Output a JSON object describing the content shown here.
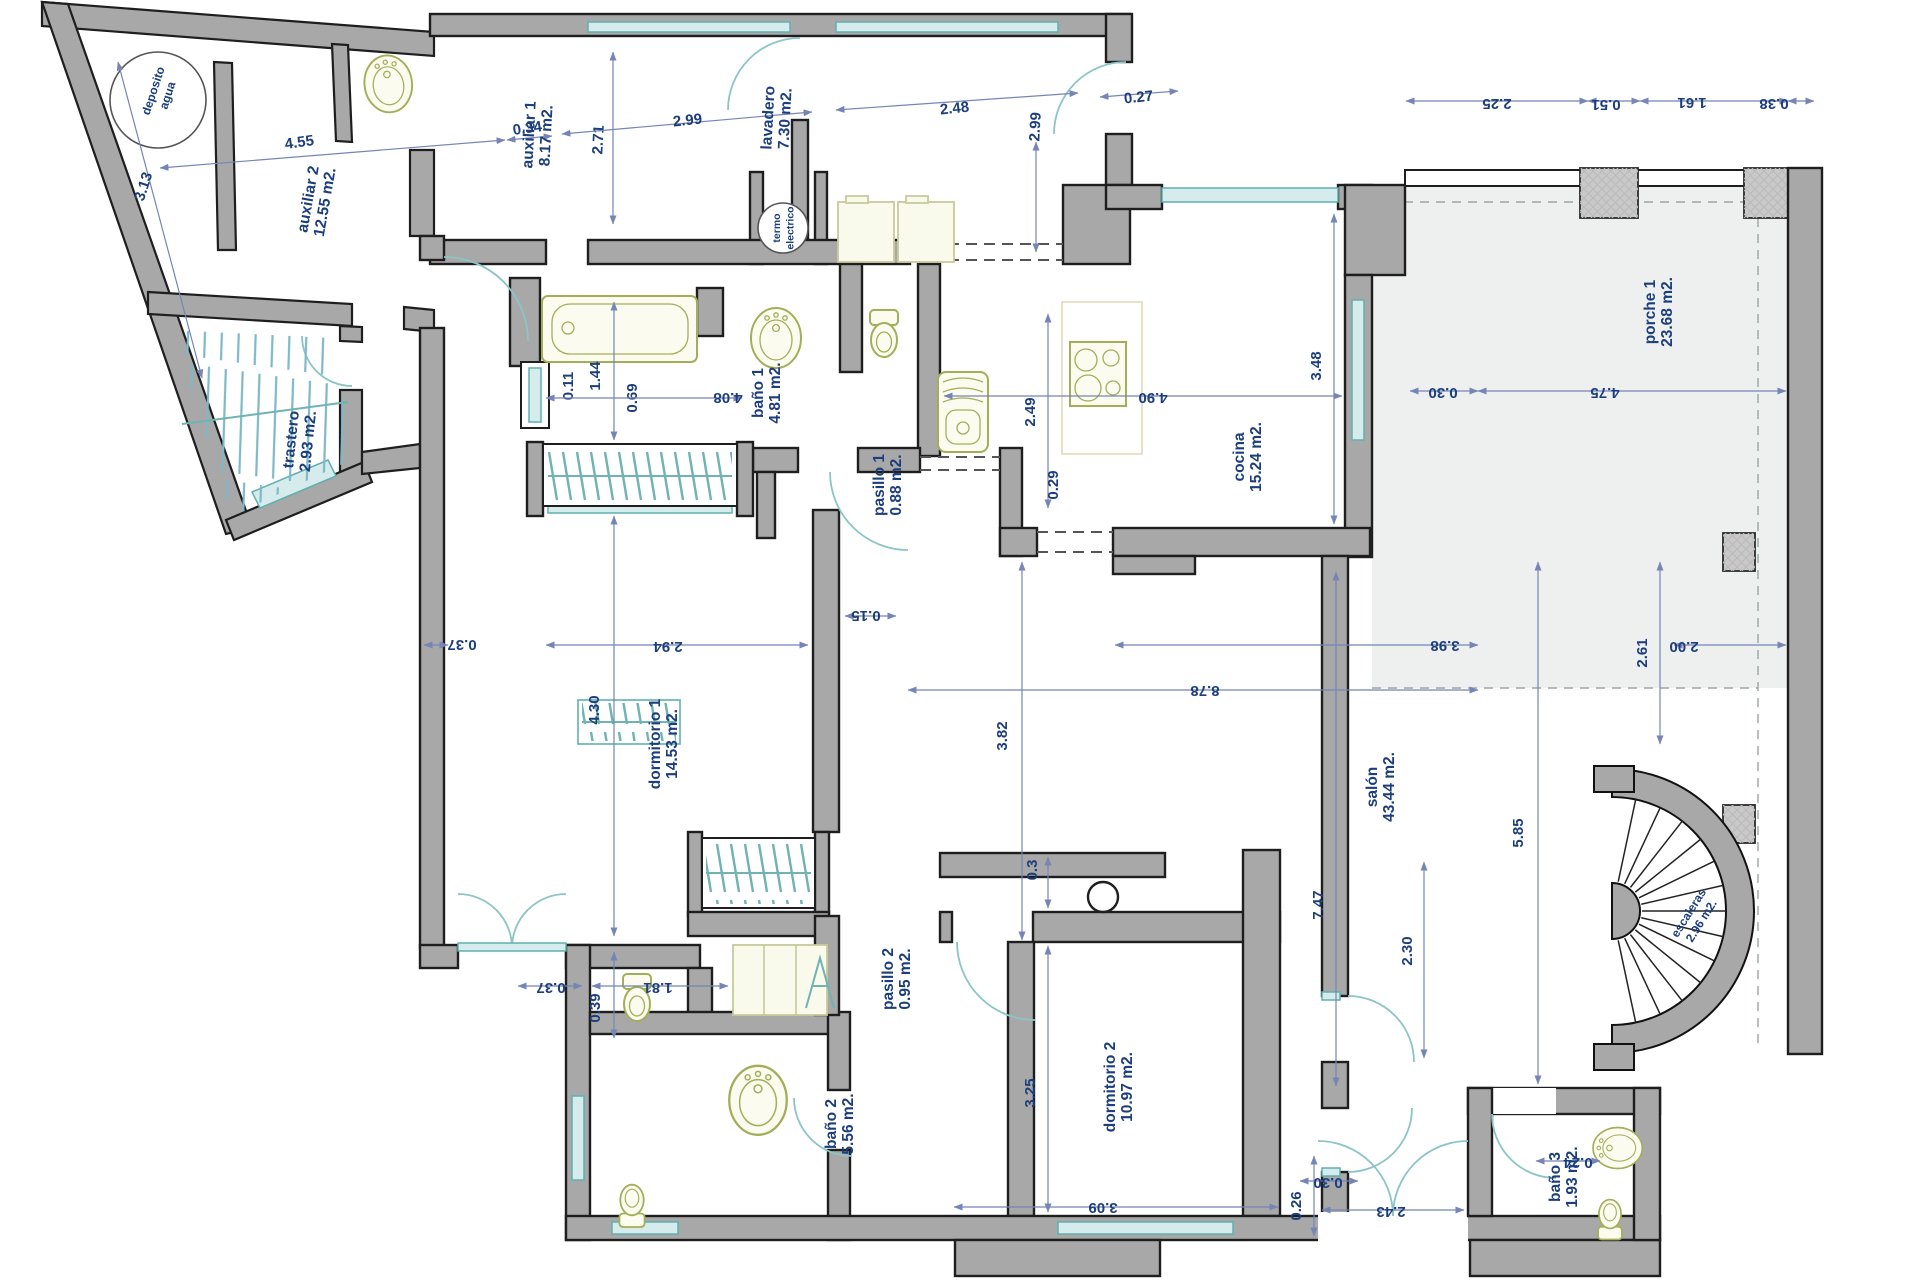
{
  "drawing": {
    "type": "architectural-floor-plan",
    "units": "m2",
    "colors": {
      "wall_gray": "#a8a8a8",
      "outline": "#1e1e1e",
      "dim_blue": "#7585b5",
      "text_navy": "#1c3e7c",
      "window_teal": "#8cc5c5",
      "fixture_olive": "#a3af58",
      "porch_fill": "#eef0f0"
    }
  },
  "rooms": [
    {
      "id": "deposito",
      "label": "deposito",
      "area": "agua",
      "x": 157,
      "y": 92,
      "r": -72,
      "size": 12
    },
    {
      "id": "auxiliar-2",
      "label": "auxiliar 2",
      "area": "12.55 m2.",
      "x": 313,
      "y": 200,
      "r": -80
    },
    {
      "id": "auxiliar-1",
      "label": "auxiliar 1",
      "area": "8.17 m2.",
      "x": 534,
      "y": 135,
      "r": -87
    },
    {
      "id": "lavadero",
      "label": "lavadero",
      "area": "7.30 m2.",
      "x": 773,
      "y": 118,
      "r": -87
    },
    {
      "id": "termo",
      "label": "termo",
      "area": "electrico",
      "x": 780,
      "y": 228,
      "r": -90,
      "size": 10.5
    },
    {
      "id": "bano-1",
      "label": "baño 1",
      "area": "4.81 m2.",
      "x": 763,
      "y": 393,
      "r": -90
    },
    {
      "id": "pasillo-1",
      "label": "pasillo 1",
      "area": "0.88 m2.",
      "x": 884,
      "y": 485,
      "r": -90
    },
    {
      "id": "cocina",
      "label": "cocina",
      "area": "15.24 m2.",
      "x": 1244,
      "y": 457,
      "r": -90
    },
    {
      "id": "porche-1",
      "label": "porche 1",
      "area": "23.68 m2.",
      "x": 1655,
      "y": 312,
      "r": -90
    },
    {
      "id": "trastero",
      "label": "trastero",
      "area": "2.93 m2.",
      "x": 296,
      "y": 440,
      "r": -84
    },
    {
      "id": "dormitorio-1",
      "label": "dormitorio 1",
      "area": "14.53 m2.",
      "x": 660,
      "y": 744,
      "r": -90
    },
    {
      "id": "salon",
      "label": "salón",
      "area": "43.44 m2.",
      "x": 1377,
      "y": 787,
      "r": -90
    },
    {
      "id": "dormitorio-2",
      "label": "dormitorio 2",
      "area": "10.97 m2.",
      "x": 1115,
      "y": 1087,
      "r": -90
    },
    {
      "id": "pasillo-2",
      "label": "pasillo 2",
      "area": "0.95 m2.",
      "x": 893,
      "y": 979,
      "r": -90
    },
    {
      "id": "bano-2",
      "label": "baño 2",
      "area": "5.56 m2.",
      "x": 836,
      "y": 1124,
      "r": -90
    },
    {
      "id": "bano-3",
      "label": "baño 3",
      "area": "1.93 m2.",
      "x": 1560,
      "y": 1177,
      "r": -90
    },
    {
      "id": "escaleras",
      "label": "escaleras",
      "area": "2.96 m2.",
      "x": 1692,
      "y": 915,
      "r": -58,
      "size": 12
    }
  ],
  "dimensions": [
    {
      "v": "4.55",
      "x": 300,
      "y": 147,
      "r": -8,
      "line": [
        160,
        168,
        505,
        140
      ]
    },
    {
      "v": "3.13",
      "x": 148,
      "y": 188,
      "r": -72,
      "line": [
        118,
        62,
        202,
        378
      ]
    },
    {
      "v": "0.34",
      "x": 528,
      "y": 133,
      "r": -8,
      "line": [
        507,
        140,
        552,
        136
      ]
    },
    {
      "v": "2.71",
      "x": 603,
      "y": 140,
      "r": -87,
      "line": [
        613,
        52,
        613,
        224
      ]
    },
    {
      "v": "2.99",
      "x": 688,
      "y": 125,
      "r": -6,
      "line": [
        562,
        134,
        812,
        112
      ]
    },
    {
      "v": "2.48",
      "x": 955,
      "y": 113,
      "r": -6,
      "line": [
        836,
        110,
        1078,
        93
      ]
    },
    {
      "v": "2.99",
      "x": 1040,
      "y": 127,
      "r": -87,
      "line": [
        1036,
        142,
        1036,
        252
      ]
    },
    {
      "v": "0.27",
      "x": 1139,
      "y": 102,
      "r": -6,
      "line": [
        1100,
        97,
        1178,
        91
      ]
    },
    {
      "v": "2.25",
      "x": 1497,
      "y": 99,
      "r": 180,
      "line": [
        1406,
        101,
        1588,
        101
      ]
    },
    {
      "v": "0.51",
      "x": 1606,
      "y": 100,
      "r": 180,
      "line": [
        1588,
        101,
        1640,
        101
      ]
    },
    {
      "v": "1.61",
      "x": 1692,
      "y": 98,
      "r": 180,
      "line": [
        1640,
        101,
        1788,
        101
      ]
    },
    {
      "v": "0.38",
      "x": 1774,
      "y": 99,
      "r": 180,
      "line": [
        1788,
        101,
        1814,
        101
      ]
    },
    {
      "v": "0.30",
      "x": 1443,
      "y": 388,
      "r": 180,
      "line": [
        1410,
        391,
        1478,
        391
      ]
    },
    {
      "v": "4.75",
      "x": 1605,
      "y": 388,
      "r": 180,
      "line": [
        1478,
        391,
        1786,
        391
      ]
    },
    {
      "v": "3.48",
      "x": 1321,
      "y": 366,
      "r": -90,
      "line": [
        1334,
        214,
        1334,
        524
      ]
    },
    {
      "v": "4.90",
      "x": 1153,
      "y": 393,
      "r": 180,
      "line": [
        944,
        396,
        1342,
        396
      ]
    },
    {
      "v": "2.49",
      "x": 1035,
      "y": 412,
      "r": -90,
      "line": [
        1048,
        314,
        1048,
        508
      ]
    },
    {
      "v": "0.29",
      "x": 1058,
      "y": 485,
      "r": -90,
      "line": null
    },
    {
      "v": "0.11",
      "x": 573,
      "y": 386,
      "r": -90,
      "line": null
    },
    {
      "v": "1.44",
      "x": 600,
      "y": 376,
      "r": -90,
      "line": [
        614,
        302,
        614,
        440
      ]
    },
    {
      "v": "0.69",
      "x": 637,
      "y": 398,
      "r": -90,
      "line": null
    },
    {
      "v": "4.08",
      "x": 728,
      "y": 393,
      "r": 180,
      "line": [
        546,
        398,
        742,
        398
      ]
    },
    {
      "v": "0.37",
      "x": 462,
      "y": 640,
      "r": 180,
      "line": [
        424,
        645,
        448,
        645
      ]
    },
    {
      "v": "2.94",
      "x": 668,
      "y": 642,
      "r": 180,
      "line": [
        546,
        645,
        808,
        645
      ]
    },
    {
      "v": "4.30",
      "x": 599,
      "y": 710,
      "r": -90,
      "line": [
        614,
        516,
        614,
        936
      ]
    },
    {
      "v": "0.15",
      "x": 866,
      "y": 611,
      "r": 180,
      "line": [
        845,
        616,
        896,
        616
      ]
    },
    {
      "v": "8.78",
      "x": 1205,
      "y": 686,
      "r": 180,
      "line": [
        908,
        690,
        1478,
        690
      ]
    },
    {
      "v": "3.82",
      "x": 1007,
      "y": 736,
      "r": -90,
      "line": [
        1022,
        562,
        1022,
        940
      ]
    },
    {
      "v": "3.98",
      "x": 1445,
      "y": 641,
      "r": 180,
      "line": [
        1115,
        645,
        1478,
        645
      ]
    },
    {
      "v": "2.61",
      "x": 1647,
      "y": 653,
      "r": -90,
      "line": [
        1660,
        562,
        1660,
        744
      ]
    },
    {
      "v": "2.00",
      "x": 1684,
      "y": 642,
      "r": 180,
      "line": [
        1674,
        645,
        1786,
        645
      ]
    },
    {
      "v": "5.85",
      "x": 1523,
      "y": 833,
      "r": -90,
      "line": [
        1538,
        562,
        1538,
        1084
      ]
    },
    {
      "v": "7.47",
      "x": 1323,
      "y": 905,
      "r": -90,
      "line": [
        1336,
        572,
        1336,
        1086
      ]
    },
    {
      "v": "0.39",
      "x": 600,
      "y": 1008,
      "r": -90,
      "line": [
        614,
        952,
        614,
        1038
      ]
    },
    {
      "v": "3.25",
      "x": 1035,
      "y": 1093,
      "r": -90,
      "line": [
        1048,
        946,
        1048,
        1212
      ]
    },
    {
      "v": "0.3",
      "x": 1037,
      "y": 870,
      "r": -90,
      "line": [
        1048,
        857,
        1048,
        908
      ]
    },
    {
      "v": "0.37",
      "x": 551,
      "y": 983,
      "r": 180,
      "line": [
        518,
        986,
        582,
        986
      ]
    },
    {
      "v": "1.81",
      "x": 658,
      "y": 983,
      "r": 180,
      "line": [
        592,
        986,
        728,
        986
      ]
    },
    {
      "v": "3.09",
      "x": 1103,
      "y": 1203,
      "r": 180,
      "line": [
        954,
        1207,
        1278,
        1207
      ]
    },
    {
      "v": "0.26",
      "x": 1301,
      "y": 1206,
      "r": -90,
      "line": [
        1314,
        1156,
        1314,
        1236
      ]
    },
    {
      "v": "0.30",
      "x": 1328,
      "y": 1178,
      "r": 180,
      "line": [
        1300,
        1181,
        1358,
        1181
      ]
    },
    {
      "v": "2.43",
      "x": 1391,
      "y": 1207,
      "r": 180,
      "line": [
        1322,
        1210,
        1464,
        1210
      ]
    },
    {
      "v": "0.24",
      "x": 1578,
      "y": 1158,
      "r": 180,
      "line": [
        1536,
        1161,
        1600,
        1161
      ]
    },
    {
      "v": "2.30",
      "x": 1412,
      "y": 951,
      "r": -90,
      "line": [
        1424,
        862,
        1424,
        1058
      ]
    }
  ]
}
